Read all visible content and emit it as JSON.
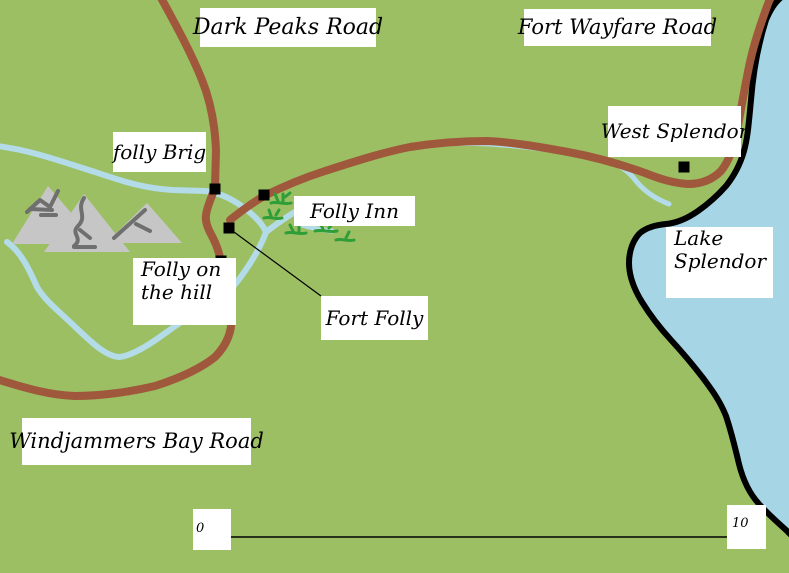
{
  "map": {
    "colors": {
      "background": "#9CBF63",
      "road": "#A0583C",
      "river": "#B3DCE8",
      "lake": "#A6D6E6",
      "shoreline": "#000000",
      "mountain_fill": "#C6C6C6",
      "mountain_ridge": "#6F6F6F",
      "vegetation": "#2F9E38",
      "label_background": "#FFFFFF",
      "label_text": "#000000"
    },
    "labels": {
      "dark_peaks_road": "Dark Peaks Road",
      "fort_wayfare_road": "Fort Wayfare Road",
      "west_splendor": "West Splendor",
      "folly_brig": "folly Brig",
      "folly_inn": "Folly Inn",
      "folly_on_the_hill": [
        "Folly on",
        "the hill"
      ],
      "fort_folly": "Fort Folly",
      "windjammers_bay_road": "Windjammers Bay Road",
      "lake_splendor": [
        "Lake",
        "Splendor"
      ]
    },
    "scale_bar": {
      "start_label": "0",
      "end_label": "10"
    },
    "markers": [
      {
        "name": "folly Brig"
      },
      {
        "name": "Folly Inn"
      },
      {
        "name": "Fort Folly"
      },
      {
        "name": "Folly on the hill"
      },
      {
        "name": "West Splendor"
      }
    ],
    "features": {
      "lake": "Lake Splendor",
      "mountains": "Dark Peaks",
      "rivers": "unnamed rivers",
      "roads": [
        "Dark Peaks Road",
        "Fort Wayfare Road",
        "Windjammers Bay Road"
      ]
    }
  }
}
